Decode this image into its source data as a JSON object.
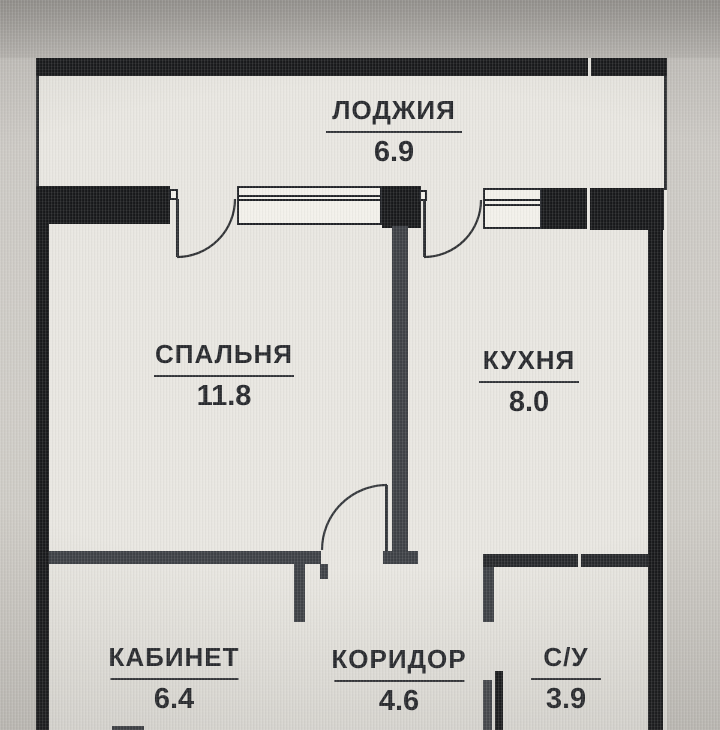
{
  "rooms": [
    {
      "name": "ЛОДЖИЯ",
      "area": "6.9"
    },
    {
      "name": "СПАЛЬНЯ",
      "area": "11.8"
    },
    {
      "name": "КУХНЯ",
      "area": "8.0"
    },
    {
      "name": "КАБИНЕТ",
      "area": "6.4"
    },
    {
      "name": "КОРИДОР",
      "area": "4.6"
    },
    {
      "name": "С/У",
      "area": "3.9"
    }
  ],
  "colors": {
    "wall-ext": "#17181a",
    "wall-int": "#3d4045",
    "line": "#2e3033",
    "text": "#26282c",
    "photo-bg": "#c6c3be",
    "plan-bg": "#e8e6e0"
  }
}
